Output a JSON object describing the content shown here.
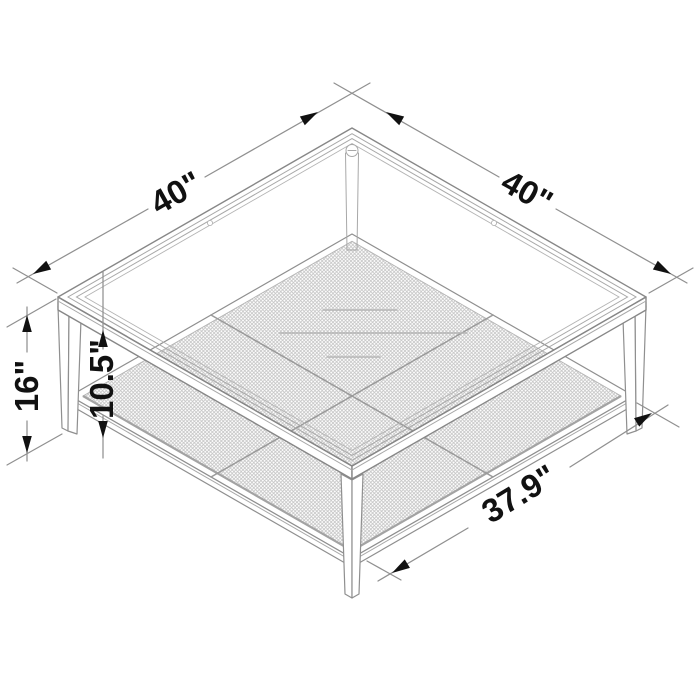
{
  "diagram": {
    "subject": "Square coffee table with clear glass top and metal mesh lower shelf",
    "style": "isometric line drawing with dimension callouts",
    "dimensions": {
      "top_width": {
        "label": "40\"",
        "value": 40,
        "unit": "inches",
        "measures": "tabletop left edge"
      },
      "top_depth": {
        "label": "40\"",
        "value": 40,
        "unit": "inches",
        "measures": "tabletop right edge"
      },
      "overall_height": {
        "label": "16\"",
        "value": 16,
        "unit": "inches",
        "measures": "floor to tabletop"
      },
      "shelf_clearance": {
        "label": "10.5\"",
        "value": 10.5,
        "unit": "inches",
        "measures": "underside of top to mesh shelf"
      },
      "shelf_width": {
        "label": "37.9\"",
        "value": 37.9,
        "unit": "inches",
        "measures": "lower shelf front edge"
      }
    },
    "colors": {
      "background": "#ffffff",
      "line": "#8f8f8f",
      "mesh": "#c4c4c4",
      "annotation": "#111111"
    }
  }
}
